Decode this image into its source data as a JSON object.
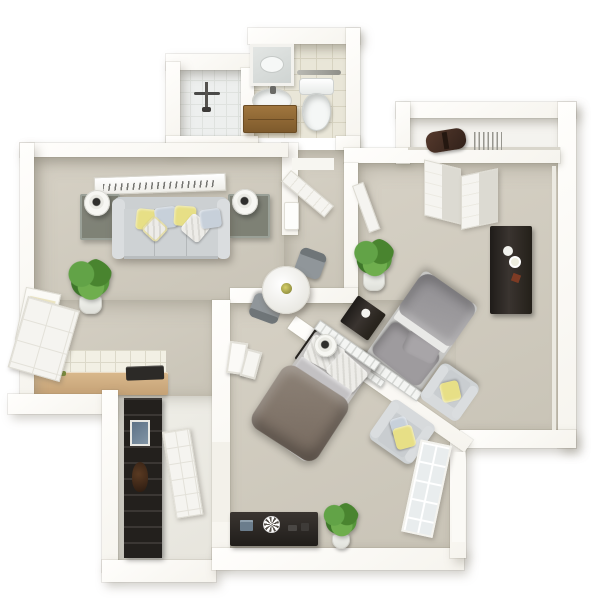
{
  "scene": {
    "description": "3D rendered top-down floor plan of an apartment, no visible text",
    "view": "isometric top-down render",
    "background": "#ffffff"
  },
  "palette": {
    "background": "#ffffff",
    "wall": "#f6f4ee",
    "carpet": "#d6d1c5",
    "carpet_dark": "#c9c4b7",
    "tile": "#e9e6d8",
    "grout": "#d7d3c1",
    "counter_tan": "#d9b98c",
    "wood_cabinet": "#a0763e",
    "dark_furniture": "#2c2825",
    "sofa_gray": "#ced2d4",
    "pillow_yellow": "#e7df86",
    "pillow_blue": "#c7d0da",
    "bed_gray": "#9e9b9e",
    "bed_taupe": "#8e8378",
    "plant": "#62a347",
    "plant_dark": "#49842f",
    "pot": "#f1f2ed",
    "toilet_white": "#f5f7f6"
  },
  "rooms": [
    {
      "name": "bathroom",
      "floor": "tile",
      "furniture": [
        "walk-in-shower",
        "shower-fixture",
        "vanity-mirror",
        "sink",
        "wood-vanity-cabinet",
        "toilet",
        "towel-bar"
      ]
    },
    {
      "name": "top-closet",
      "floor": "white",
      "furniture": [
        "duffel-bag",
        "wire-hangers"
      ]
    },
    {
      "name": "living-room",
      "floor": "carpet",
      "furniture": [
        "wall-art",
        "glass-end-table-left",
        "table-lamp-left",
        "sofa",
        "throw-pillows",
        "glass-end-table-right",
        "table-lamp-right",
        "potted-plant",
        "wall-poster",
        "wall-unit"
      ]
    },
    {
      "name": "kitchenette",
      "floor": "carpet",
      "furniture": [
        "tile-backsplash",
        "tan-counter",
        "cooktop",
        "open-cabinet-door"
      ]
    },
    {
      "name": "dining-nook",
      "floor": "carpet",
      "furniture": [
        "round-dining-table",
        "centerpiece",
        "dining-chair",
        "dining-chair"
      ]
    },
    {
      "name": "hallway",
      "floor": "carpet",
      "furniture": [
        "open-door-to-bathroom",
        "open-door-to-bedroom"
      ]
    },
    {
      "name": "bedroom-right",
      "floor": "carpet",
      "furniture": [
        "bifold-closet-doors",
        "potted-plant",
        "gray-bed",
        "slatted-headboard",
        "dark-nightstand",
        "tall-dark-dresser",
        "armchair-with-yellow-pillow"
      ]
    },
    {
      "name": "bedroom-bottom",
      "floor": "carpet",
      "furniture": [
        "taupe-bed",
        "slatted-headboard",
        "nightstand-with-lamp",
        "armchair-with-pillows",
        "dark-media-console",
        "decor-clock",
        "book-stack",
        "potted-plant",
        "leaning-frames",
        "french-door"
      ]
    },
    {
      "name": "entry-corridor",
      "floor": "light",
      "furniture": [
        "dark-shelving-closet",
        "small-picture",
        "dark-bottle",
        "paneled-door"
      ]
    }
  ]
}
